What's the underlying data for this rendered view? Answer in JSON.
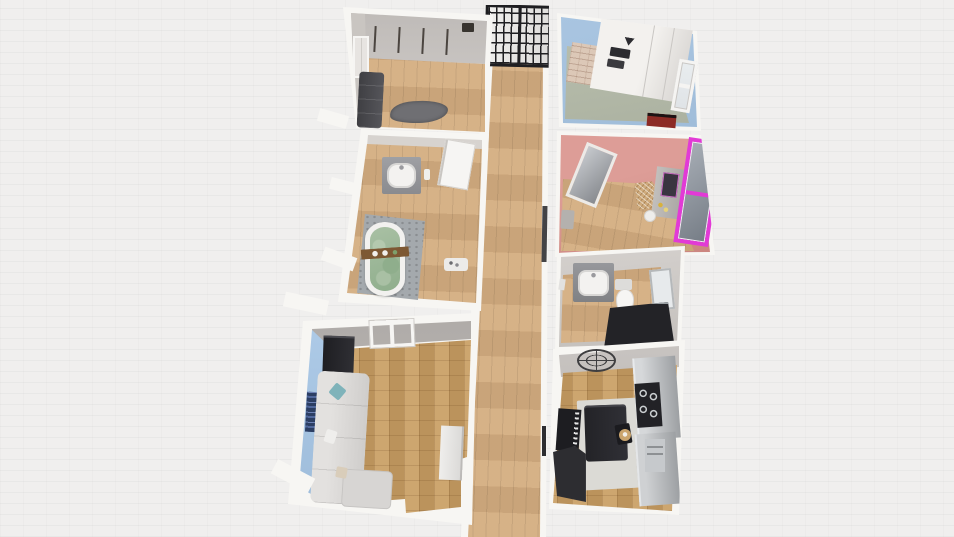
{
  "scene": {
    "type": "3d-floorplan-render",
    "view": "top-down perspective",
    "background_texture": "white brick wall"
  },
  "colors": {
    "bg": "#f0efee",
    "wall-white": "#f7f6f3",
    "wall-gray": "#c6c2be",
    "wall-gray-dark": "#b2aeab",
    "wood": "#d4ad80",
    "parquet": "#c99e63",
    "blue-wall": "#a7c4e2",
    "sage-floor": "#b7bcab",
    "pink-wall": "#d89691",
    "pink-wall-deep": "#c47e79",
    "magenta": "#e23ad6",
    "sofa-light": "#d8d6d3",
    "dark-furn": "#2e2e32",
    "counter-gray": "#b0b3b6",
    "mat-gray": "#a4a9ad",
    "tub-green": "#9cb79a",
    "brick-tan": "#dcc8b7",
    "red-accent": "#8c2b25",
    "frame-black": "#1f1f22",
    "teal": "#7fb3ba"
  },
  "rooms": {
    "hallway": {
      "label": "Hallway",
      "floor": "light wood planks",
      "items": [
        "black grid entry door",
        "wall tv panel"
      ]
    },
    "closet": {
      "label": "Wardrobe Room",
      "floor": "wood",
      "items": [
        "wardrobe hanging rails",
        "dark sofa",
        "gray rug",
        "wall frame",
        "speaker"
      ]
    },
    "bath_main": {
      "label": "Main Bathroom",
      "floor": "wood + gray mat",
      "items": [
        "freestanding bathtub",
        "bath caddy tray",
        "vanity sink",
        "open door",
        "bath rug"
      ]
    },
    "living": {
      "label": "Living Room",
      "floor": "parquet",
      "items": [
        "sectional sofa",
        "teal pillow",
        "window",
        "black cabinet",
        "wall art",
        "tv stand"
      ]
    },
    "kitchen_top": {
      "label": "Kitchen Nook",
      "floor": "sage tiles",
      "items": [
        "white cabinet unit",
        "cooktop marks",
        "brick column",
        "window",
        "red mat"
      ]
    },
    "bedroom": {
      "label": "Pink Bedroom",
      "floor": "wood",
      "items": [
        "leaning mirror",
        "dresser vanity",
        "rattan chair",
        "round stool",
        "magenta framed window",
        "gray stool"
      ]
    },
    "bath_small": {
      "label": "Second Bathroom",
      "floor": "wood",
      "items": [
        "vanity sink",
        "toilet",
        "mirror cabinet",
        "dark shower"
      ]
    },
    "kitchen": {
      "label": "Kitchen & Dining",
      "floor": "parquet",
      "items": [
        "wall clock",
        "counter run",
        "cooktop with burners",
        "dishwasher",
        "dark dining table",
        "chair",
        "keyboard piano",
        "dark sofa",
        "area rug"
      ]
    }
  }
}
